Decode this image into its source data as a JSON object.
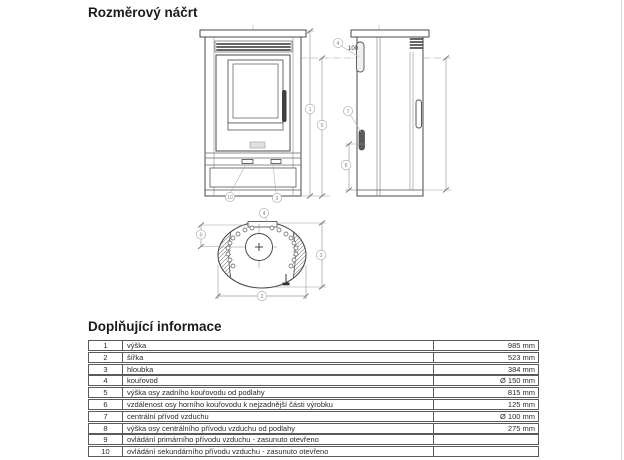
{
  "page": {
    "title": "Rozměrový náčrt",
    "info_title": "Doplňující informace"
  },
  "drawing": {
    "note_100": "100",
    "callouts": {
      "c1": "1",
      "c2": "2",
      "c3": "3",
      "c4": "4",
      "c5": "5",
      "c6": "6",
      "c7": "7",
      "c8": "8",
      "c9": "9",
      "c10": "10"
    }
  },
  "info_table": {
    "rows": [
      {
        "num": "1",
        "desc": "výška",
        "value": "985 mm"
      },
      {
        "num": "2",
        "desc": "šířka",
        "value": "523 mm"
      },
      {
        "num": "3",
        "desc": "hloubka",
        "value": "384 mm"
      },
      {
        "num": "4",
        "desc": "kouřovod",
        "value": "Ø 150 mm"
      },
      {
        "num": "5",
        "desc": "výška osy zadního kouřovodu od podlahy",
        "value": "815 mm"
      },
      {
        "num": "6",
        "desc": "vzdálenost osy horního kouřovodu k nejzadnější části výrobku",
        "value": "125 mm"
      },
      {
        "num": "7",
        "desc": "centrální přívod vzduchu",
        "value": "Ø 100 mm"
      },
      {
        "num": "8",
        "desc": "výška osy centrálního přívodu vzduchu od podlahy",
        "value": "275 mm"
      },
      {
        "num": "9",
        "desc": "ovládání primárního přívodu vzduchu - zasunuto otevřeno",
        "value": ""
      },
      {
        "num": "10",
        "desc": "ovládání sekundárního přívodu vzduchu - zasunuto otevřeno",
        "value": ""
      }
    ]
  }
}
